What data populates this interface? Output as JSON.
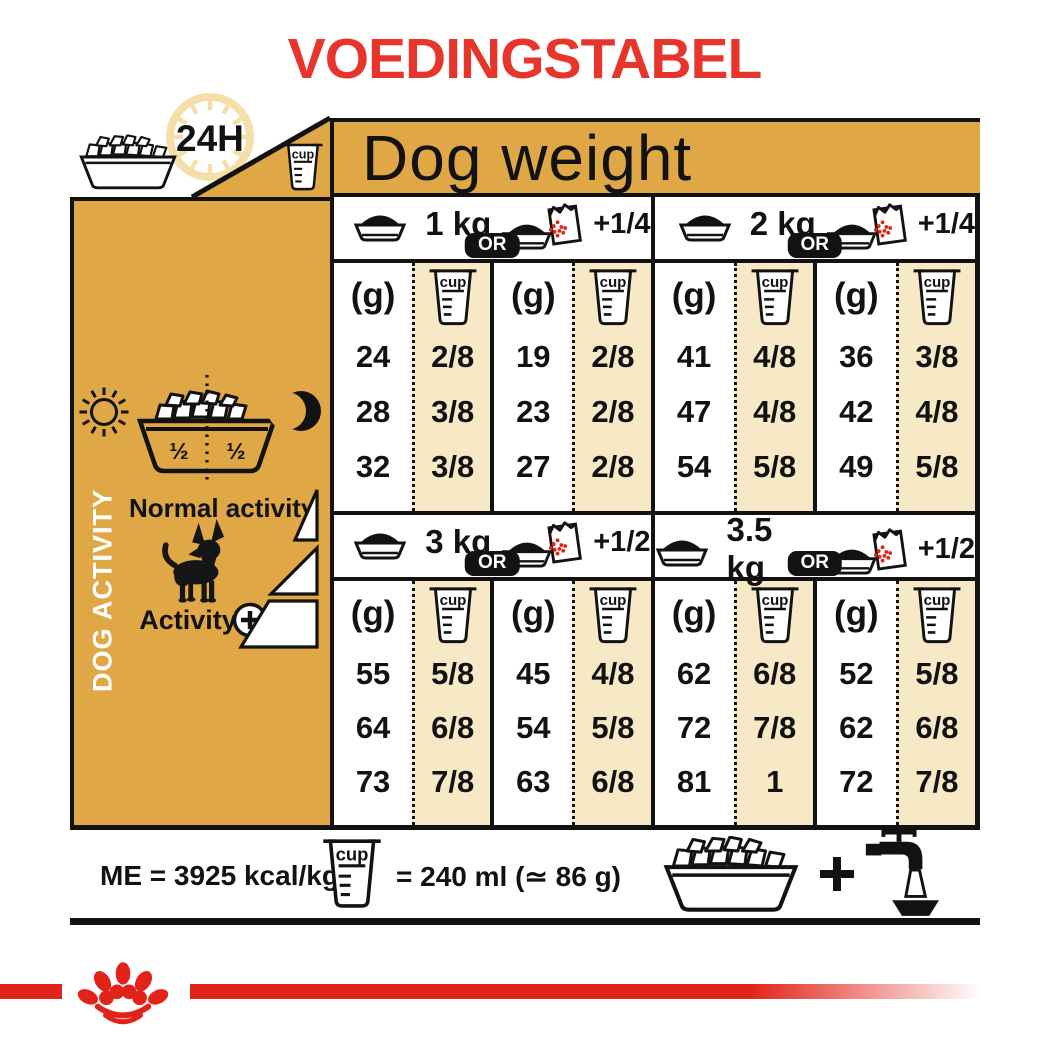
{
  "title": "VOEDINGSTABEL",
  "corner": {
    "hours": "24H"
  },
  "table": {
    "header": "Dog weight",
    "or_label": "OR",
    "grams_header": "(g)",
    "cup_text": "cup",
    "sections": [
      {
        "weight": "1 kg",
        "extra": "+1/4",
        "dry_g": [
          "24",
          "28",
          "32"
        ],
        "dry_cup": [
          "2/8",
          "3/8",
          "3/8"
        ],
        "mix_g": [
          "19",
          "23",
          "27"
        ],
        "mix_cup": [
          "2/8",
          "2/8",
          "2/8"
        ]
      },
      {
        "weight": "2 kg",
        "extra": "+1/4",
        "dry_g": [
          "41",
          "47",
          "54"
        ],
        "dry_cup": [
          "4/8",
          "4/8",
          "5/8"
        ],
        "mix_g": [
          "36",
          "42",
          "49"
        ],
        "mix_cup": [
          "3/8",
          "4/8",
          "5/8"
        ]
      },
      {
        "weight": "3 kg",
        "extra": "+1/2",
        "dry_g": [
          "55",
          "64",
          "73"
        ],
        "dry_cup": [
          "5/8",
          "6/8",
          "7/8"
        ],
        "mix_g": [
          "45",
          "54",
          "63"
        ],
        "mix_cup": [
          "4/8",
          "5/8",
          "6/8"
        ]
      },
      {
        "weight": "3.5 kg",
        "extra": "+1/2",
        "dry_g": [
          "62",
          "72",
          "81"
        ],
        "dry_cup": [
          "6/8",
          "7/8",
          "1"
        ],
        "mix_g": [
          "52",
          "62",
          "72"
        ],
        "mix_cup": [
          "5/8",
          "6/8",
          "7/8"
        ]
      }
    ]
  },
  "sidebar": {
    "vertical_label": "DOG ACTIVITY",
    "half_left": "½",
    "half_right": "½",
    "normal_activity": "Normal activity",
    "activity": "Activity"
  },
  "footer": {
    "me": "ME = 3925 kcal/kg",
    "cup_equivalence": "= 240 ml (≃ 86 g)"
  },
  "colors": {
    "gold": "#DFA746",
    "cream": "#F7E8C6",
    "red": "#E2231A",
    "title_red": "#E8352B",
    "ink": "#121212"
  }
}
